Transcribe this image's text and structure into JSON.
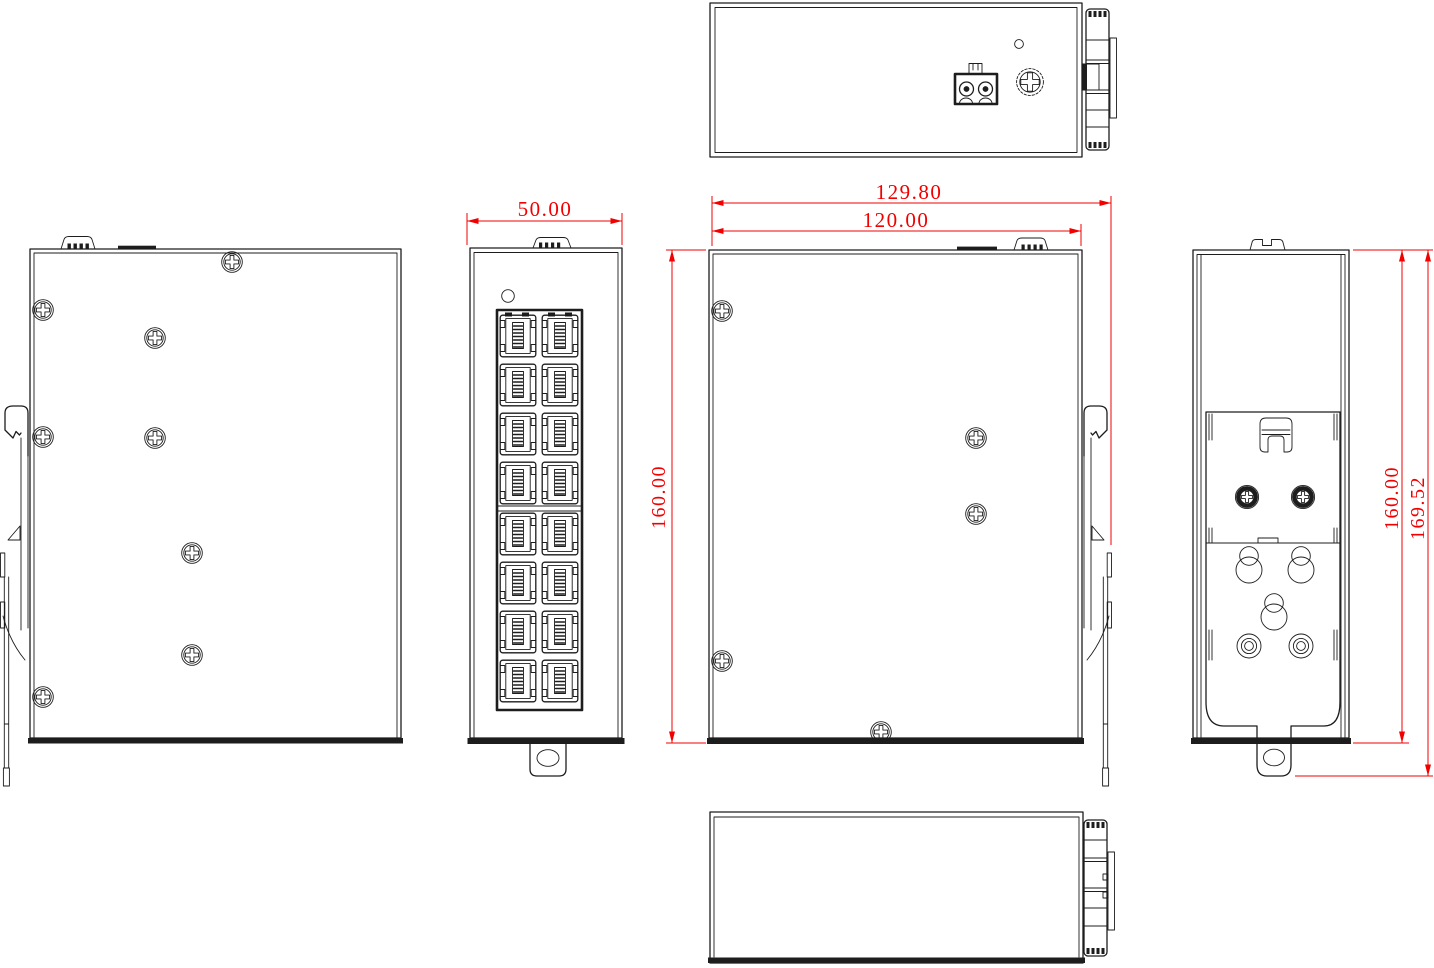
{
  "drawing": {
    "background": "#ffffff",
    "line_color": "#1d1d1d",
    "dimension_color": "#f20000",
    "dimensions": {
      "front_width": "50.00",
      "overall_depth": "129.80",
      "body_depth": "120.00",
      "left_height": "160.00",
      "right_height": "160.00",
      "overall_height": "169.52"
    },
    "ports": {
      "rows": 8,
      "columns": 2,
      "total": 16
    },
    "screws": {
      "left_side_view": 8,
      "main_side_view": 5,
      "back_view": 2
    },
    "features": [
      "power-terminal-2pin",
      "ground-screw",
      "led-indicator",
      "rj45-port-block",
      "din-rail-clip",
      "wall-mount-bracket",
      "mounting-tab"
    ]
  }
}
